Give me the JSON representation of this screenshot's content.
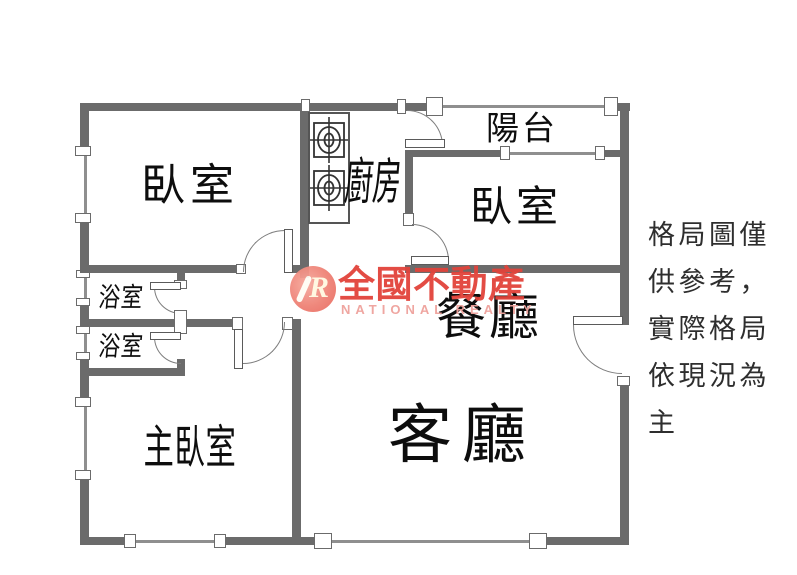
{
  "rooms": {
    "bedroom_top_left": "臥室",
    "kitchen": "廚房",
    "balcony": "陽台",
    "bedroom_right": "臥室",
    "dining": "餐廳",
    "living": "客廳",
    "bathroom_upper": "浴室",
    "bathroom_lower": "浴室",
    "master_bedroom": "主臥室"
  },
  "watermark": {
    "logo_letter": "R",
    "brand": "全國不動產",
    "brand_en": "NATIONAL REALTY"
  },
  "disclaimer": {
    "line1": "格局圖僅",
    "line2": "供參考，",
    "line3": "實際格局",
    "line4": "依現況為",
    "line5": "主"
  },
  "colors": {
    "wall": "#6b6b6b",
    "watermark_red": "#e2433b",
    "watermark_pink": "#efa29c",
    "logo_circle": "#ef8276"
  }
}
